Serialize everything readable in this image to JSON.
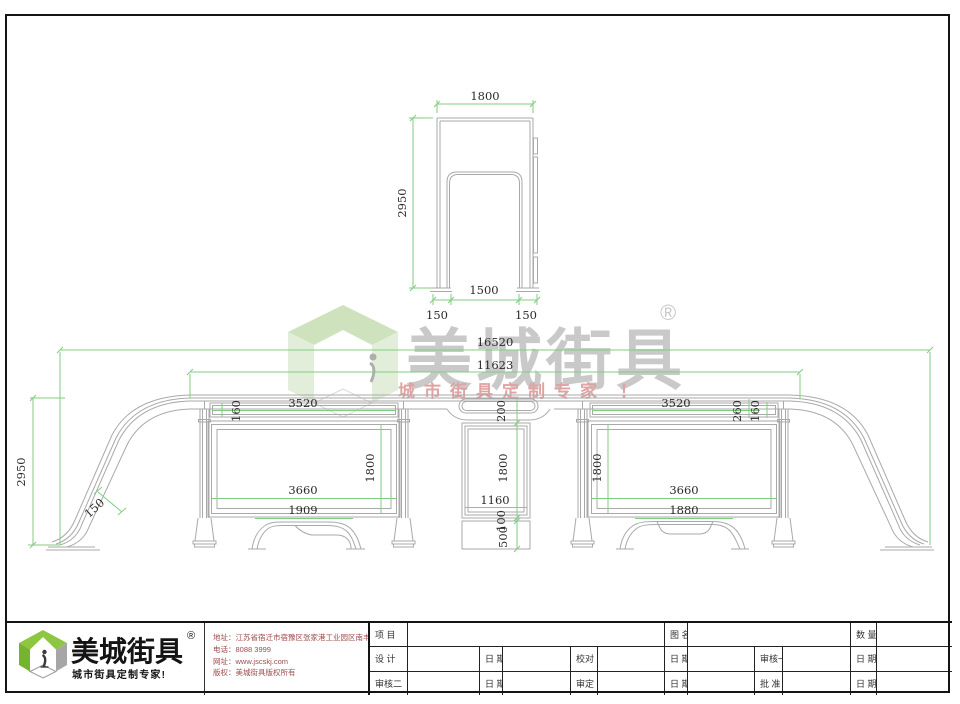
{
  "watermark": {
    "brand": "美城街具",
    "reg": "®",
    "tagline": "城市街具定制专家 ！"
  },
  "top_view": {
    "width": "1800",
    "height": "2950",
    "bottom_width": "1500",
    "leg_left": "150",
    "leg_right": "150"
  },
  "elevation": {
    "overall": "16520",
    "span": "11623",
    "height": "2950",
    "tube": "150"
  },
  "left_box": {
    "strip_w": "3520",
    "strip_h": "160",
    "panel_w": "3660",
    "panel_h": "1800",
    "bench": "1909"
  },
  "center_box": {
    "gap_top": "200",
    "h": "1800",
    "w": "1160",
    "gap_bottom": "100",
    "base": "500"
  },
  "right_box": {
    "strip_w": "3520",
    "d260": "260",
    "d160": "160",
    "panel_h": "1800",
    "panel_w": "3660",
    "bench": "1880"
  },
  "footer": {
    "brand": "美城街具",
    "reg": "®",
    "tagline": "城市街具定制专家!",
    "info": {
      "address": "地址：江苏省宿迁市宿豫区张家港工业园区南丰路西侧1号",
      "phone": "电话：8088 3999",
      "website": "网址：www.jscskj.com",
      "copyright": "版权：美城街具版权所有"
    },
    "titleblock": {
      "project": "项 目",
      "drawing_name": "图 名",
      "quantity": "数 量",
      "design": "设 计",
      "date": "日 期",
      "proofread": "校对",
      "reviewer1": "审核一",
      "reviewer2": "审核二",
      "verify": "审定",
      "approve": "批 准"
    }
  }
}
